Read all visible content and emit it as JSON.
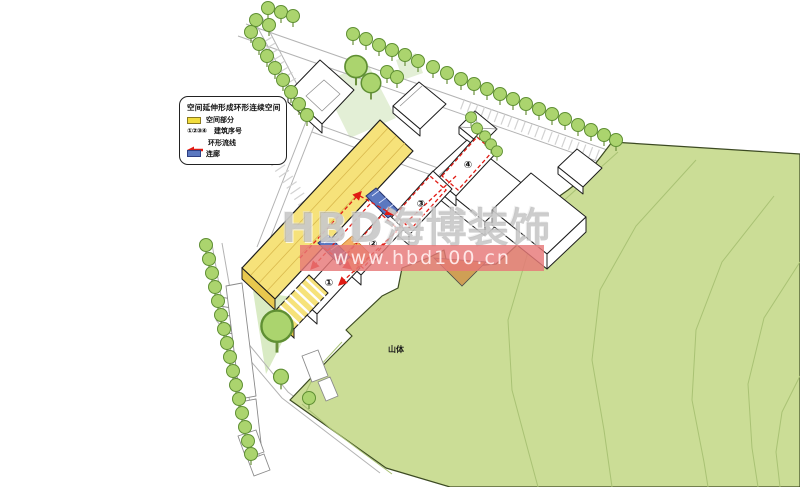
{
  "legend": {
    "title": "空间延伸形成环形连续空间",
    "items": [
      {
        "swatch": "yellow-square",
        "label": "空间部分"
      },
      {
        "swatch": "building-numbers",
        "symbol": "①②③④",
        "label": "建筑序号"
      },
      {
        "swatch": "red-arrow",
        "label": "环形流线"
      },
      {
        "swatch": "blue-square",
        "label": "连廊"
      }
    ]
  },
  "map_labels": {
    "mountain": "山体"
  },
  "buildings": [
    {
      "number": "①"
    },
    {
      "number": "②"
    },
    {
      "number": "③"
    },
    {
      "number": "④"
    }
  ],
  "watermark": {
    "brand": "HBD海博装饰",
    "url": "www.hbd100.cn"
  },
  "colors": {
    "space_yellow": "#f6e27a",
    "legend_yellow": "#f2dd3c",
    "corridor_blue": "#5b78c0",
    "route_red": "#e01b14",
    "entry_orange": "#f09d42",
    "entry_tan": "#cf9f55",
    "mountain_green": "#cbdd96",
    "contour_green": "#a9c274",
    "tree_green": "#abd46e",
    "tree_outline": "#5f8f33",
    "lawn_green": "#e3efd6",
    "lawn_mid_green": "#d9ebc4",
    "watermark_gray": "#9e9e9e",
    "band_red": "#e87777"
  }
}
